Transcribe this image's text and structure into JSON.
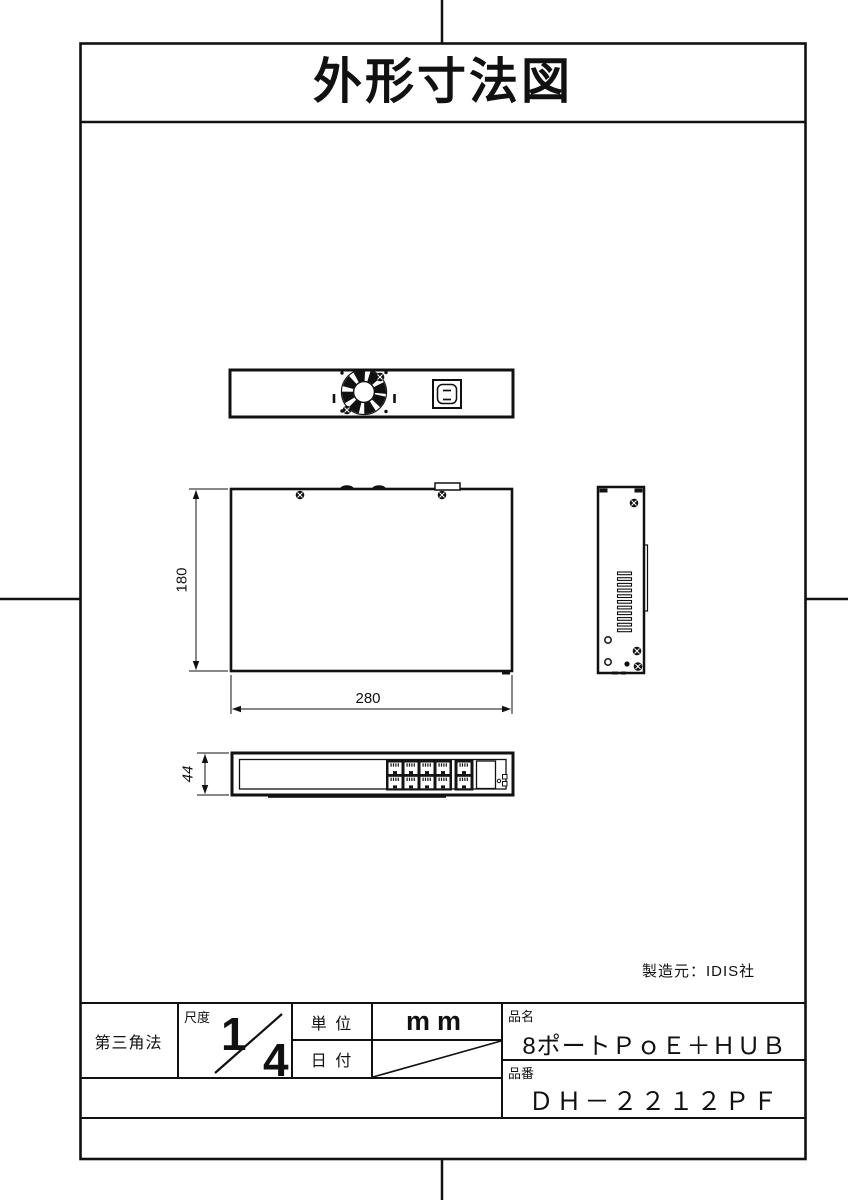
{
  "page": {
    "title": "外形寸法図",
    "manufacturer_note": "製造元：IDIS社"
  },
  "dimensions": {
    "top_view_depth": "180",
    "top_view_width": "280",
    "front_view_height": "44"
  },
  "title_block": {
    "projection_method": "第三角法",
    "scale_label": "尺度",
    "scale_numerator": "1",
    "scale_denominator": "4",
    "unit_label": "単 位",
    "unit_value": "mm",
    "date_label": "日 付",
    "product_name_label": "品名",
    "product_name_value": "8ポートＰｏＥ＋ＨＵＢ",
    "part_number_label": "品番",
    "part_number_value": "ＤＨ－２２１２ＰＦ"
  }
}
